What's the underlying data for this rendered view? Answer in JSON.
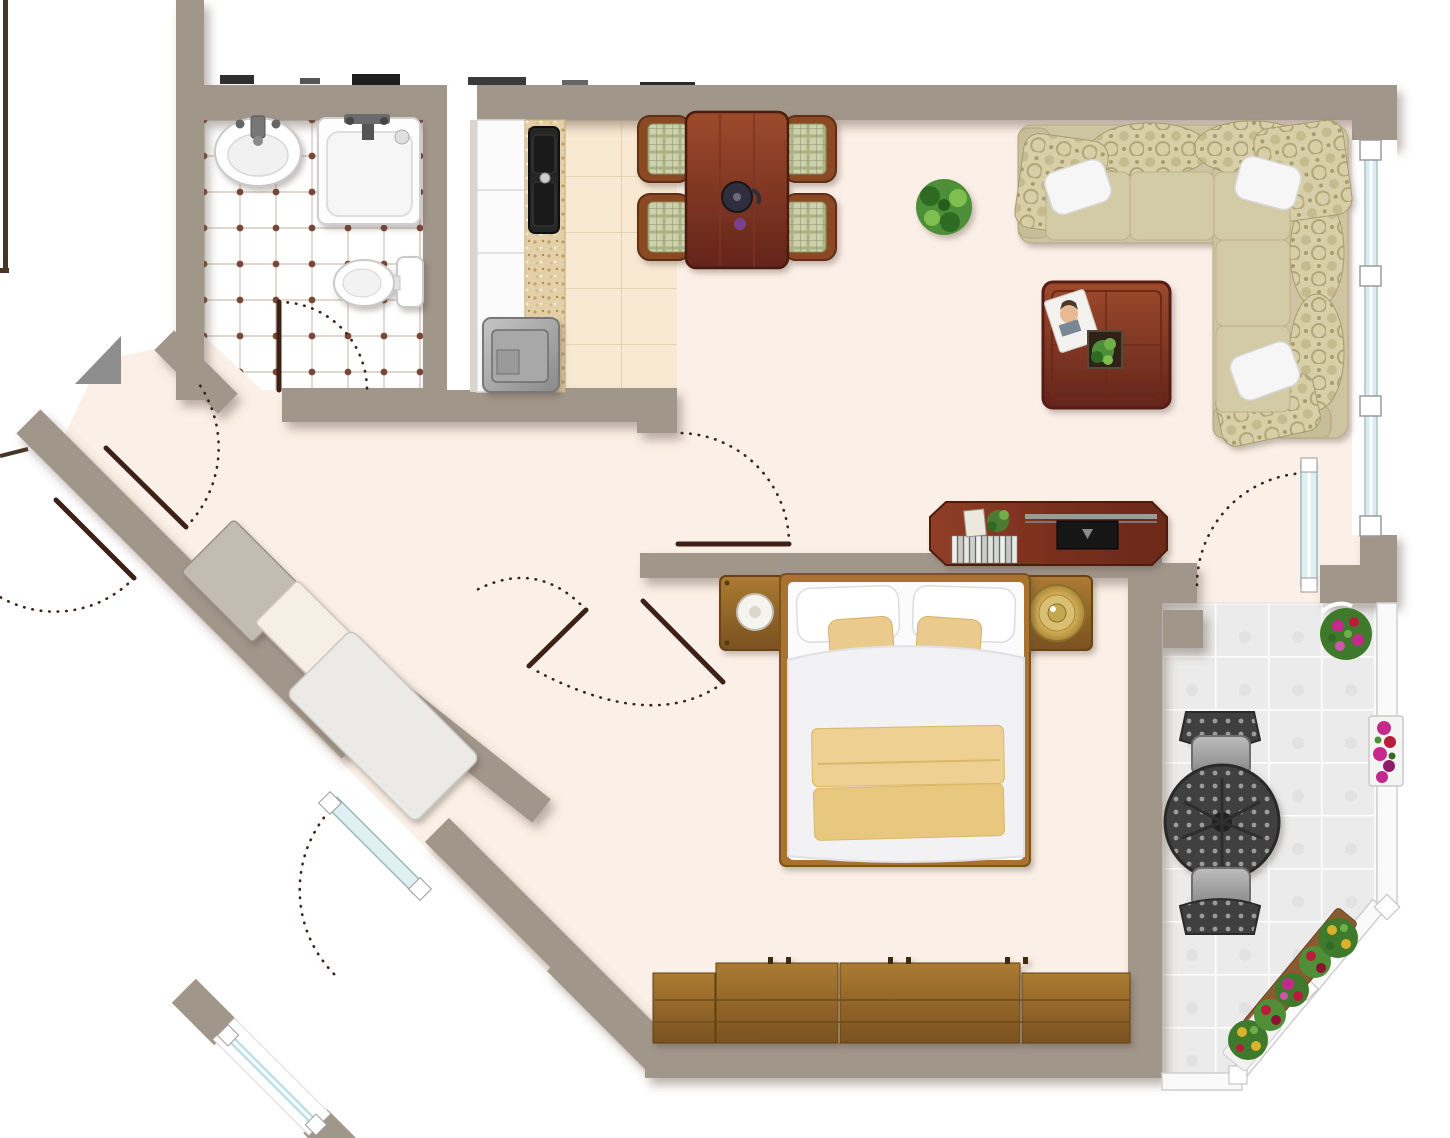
{
  "plan": {
    "type": "apartment-floor-plan",
    "view": "top-down",
    "units_shown": "none"
  },
  "colors": {
    "wall": "#a1968a",
    "floor": "#fbf0e7",
    "outside": "#ffffff",
    "bath_grout": "#d6ccbf",
    "bath_dot": "#7a4636",
    "kitchen_tile": "#f7e9d2",
    "kitchen_grout": "#e5d2b4",
    "counter": "#e3cfa8",
    "balcony_tile": "#ebebeb",
    "door": "#3d2016",
    "glass": "#d9edf1",
    "mahogany": "#8a3b25",
    "wood": "#9c6a2d",
    "sofa": "#cdc4a1",
    "sofa_pattern": "#b6ab7c",
    "accent_pillow": "#eaca8d",
    "blanket": "#edd092",
    "gold": "#c9a84e",
    "plant": "#4e8f37",
    "flower_pink": "#c42a8c",
    "flower_red": "#b91d3c",
    "flower_yellow": "#d8b32a",
    "outdoor_metal": "#454545"
  },
  "rooms": [
    {
      "id": "bathroom",
      "fixtures": [
        "wash-basin",
        "bathtub",
        "toilet",
        "tiled-floor",
        "door"
      ]
    },
    {
      "id": "kitchen",
      "fixtures": [
        "cabinet-run",
        "countertop",
        "kitchen-sink",
        "stove",
        "service-shaft"
      ]
    },
    {
      "id": "living-dining",
      "furniture": [
        "dining-table",
        "dining-chair",
        "dining-chair",
        "dining-chair",
        "dining-chair",
        "teapot",
        "potted-plant",
        "corner-sofa",
        "throw-pillows",
        "coffee-table",
        "magazine",
        "tv-sideboard",
        "window",
        "balcony-door"
      ]
    },
    {
      "id": "bedroom",
      "furniture": [
        "double-bed",
        "nightstand-left",
        "bedside-lamp",
        "nightstand-right",
        "gold-tray",
        "wardrobe-run",
        "double-door"
      ]
    },
    {
      "id": "hallway",
      "furniture": [
        "closet-gray",
        "closet-small",
        "closet-large",
        "entry-door",
        "glass-door",
        "window-segment"
      ]
    },
    {
      "id": "balcony",
      "furniture": [
        "round-bistro-table",
        "bistro-chair",
        "bistro-chair",
        "flower-pot",
        "flower-planter",
        "railing-planters",
        "railing"
      ]
    }
  ]
}
